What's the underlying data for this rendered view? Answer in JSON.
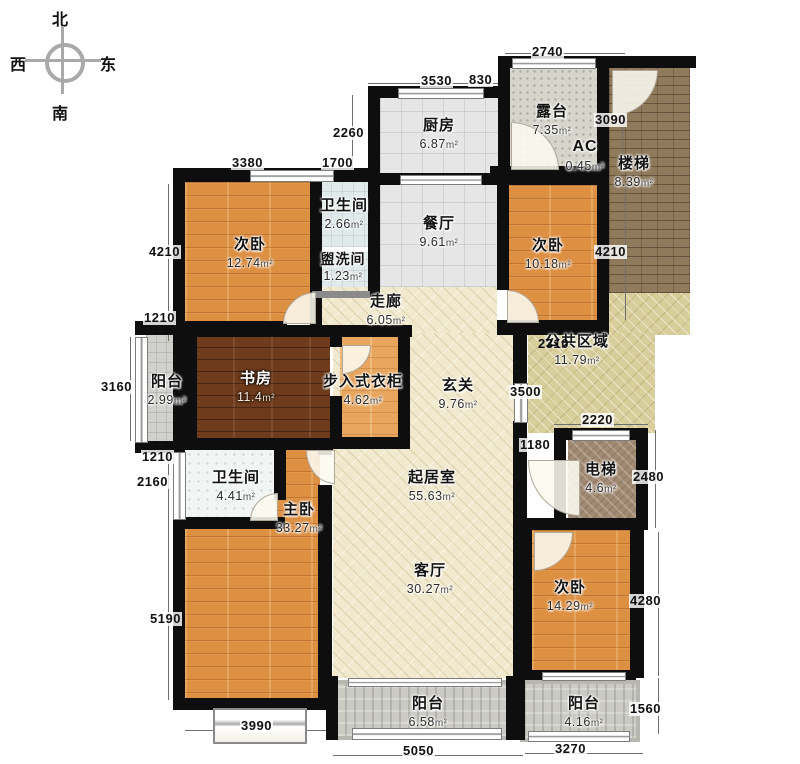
{
  "compass": {
    "north": "北",
    "west": "西",
    "east": "东",
    "south": "南"
  },
  "unit": "m²",
  "rooms": {
    "bedroom_nw": {
      "label": "次卧",
      "area": "12.74"
    },
    "bath_top": {
      "label": "卫生间",
      "area": "2.66"
    },
    "washroom": {
      "label": "盥洗间",
      "area": "1.23"
    },
    "kitchen": {
      "label": "厨房",
      "area": "6.87"
    },
    "terrace": {
      "label": "露台",
      "area": "7.35"
    },
    "ac": {
      "label": "AC",
      "area": "0.45"
    },
    "stairs": {
      "label": "楼梯",
      "area": "8.39"
    },
    "dining": {
      "label": "餐厅",
      "area": "9.61"
    },
    "bedroom_ne": {
      "label": "次卧",
      "area": "10.18"
    },
    "corridor": {
      "label": "走廊",
      "area": "6.05"
    },
    "public_area": {
      "label": "公共区域",
      "area": "11.79"
    },
    "balcony_west": {
      "label": "阳台",
      "area": "2.99"
    },
    "study": {
      "label": "书房",
      "area": "11.4"
    },
    "closet": {
      "label": "步入式衣柜",
      "area": "4.62"
    },
    "foyer": {
      "label": "玄关",
      "area": "9.76"
    },
    "elevator": {
      "label": "电梯",
      "area": "4.6"
    },
    "bath_mid": {
      "label": "卫生间",
      "area": "4.41"
    },
    "master": {
      "label": "主卧",
      "area": "33.27"
    },
    "living": {
      "label": "起居室",
      "area": "55.63"
    },
    "parlor": {
      "label": "客厅",
      "area": "30.27"
    },
    "bedroom_se": {
      "label": "次卧",
      "area": "14.29"
    },
    "balcony_s1": {
      "label": "阳台",
      "area": "6.58"
    },
    "balcony_s2": {
      "label": "阳台",
      "area": "4.16"
    }
  },
  "dims": {
    "d2740": "2740",
    "d3530": "3530",
    "d830": "830",
    "d3090": "3090",
    "d2260": "2260",
    "d1700": "1700",
    "d3380": "3380",
    "d4210_left": "4210",
    "d1210_upper": "1210",
    "d3160": "3160",
    "d1210_lower": "1210",
    "d2160": "2160",
    "d5190": "5190",
    "d3990": "3990",
    "d5050": "5050",
    "d3270": "3270",
    "d1560": "1560",
    "d4280": "4280",
    "d2480": "2480",
    "d2220": "2220",
    "d1180": "1180",
    "d3500": "3500",
    "d2310": "2310",
    "d4210_right": "4210"
  },
  "colors": {
    "wall": "#0e0e0e",
    "wood": "#dd8f42",
    "cream": "#f1e9cd",
    "tan": "#d8ce9c",
    "brick": "#8f7a5c"
  }
}
